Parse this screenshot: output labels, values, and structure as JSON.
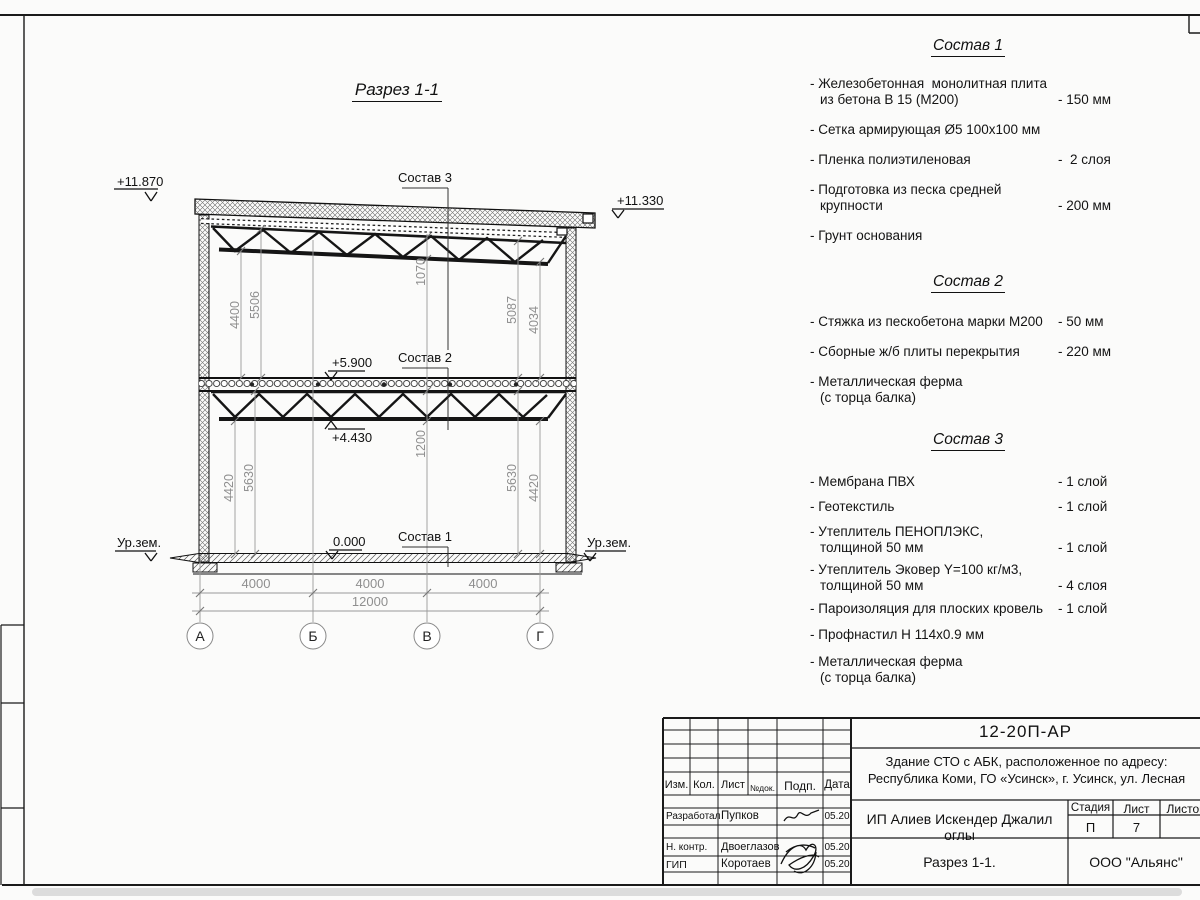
{
  "section": {
    "title": "Разрез 1-1",
    "callouts": {
      "c1": "Состав 1",
      "c2": "Состав 2",
      "c3": "Состав 3"
    },
    "elevations": {
      "roof_left": "+11.870",
      "roof_right": "+11.330",
      "floor": "+5.900",
      "truss": "+4.430",
      "zero": "0.000",
      "ground_left": "Ур.зем.",
      "ground_right": "Ур.зем."
    },
    "dims": {
      "tl1": "4400",
      "tl2": "5506",
      "mid_top": "1070",
      "tr1": "5087",
      "tr2": "4034",
      "bl1": "4420",
      "bl2": "5630",
      "mid_bot": "1200",
      "br1": "5630",
      "br2": "4420",
      "span1": "4000",
      "span2": "4000",
      "span3": "4000",
      "total": "12000"
    },
    "axes": {
      "a": "А",
      "b": "Б",
      "v": "В",
      "g": "Г"
    }
  },
  "compositions": [
    {
      "title": "Состав 1",
      "items": [
        {
          "l1": "- Железобетонная  монолитная плита",
          "l2": "из бетона В 15 (М200)",
          "v": "- 150 мм"
        },
        {
          "l1": "- Сетка армирующая Ø5 100х100 мм"
        },
        {
          "l1": "- Пленка полиэтиленовая",
          "v": "-  2 слоя"
        },
        {
          "l1": "- Подготовка из песка средней",
          "l2": "крупности",
          "v": "- 200 мм"
        },
        {
          "l1": "- Грунт основания"
        }
      ]
    },
    {
      "title": "Состав 2",
      "items": [
        {
          "l1": "- Стяжка из пескобетона марки М200",
          "v": "- 50 мм"
        },
        {
          "l1": "- Сборные ж/б плиты перекрытия",
          "v": "- 220 мм"
        },
        {
          "l1": "- Металлическая ферма",
          "l2": "(с торца балка)"
        }
      ]
    },
    {
      "title": "Состав 3",
      "items": [
        {
          "l1": "- Мембрана ПВХ",
          "v": "- 1 слой"
        },
        {
          "l1": "- Геотекстиль",
          "v": "- 1 слой"
        },
        {
          "l1": "- Утеплитель ПЕНОПЛЭКС,",
          "l2": "толщиной 50 мм",
          "v": "- 1 слой"
        },
        {
          "l1": "- Утеплитель Эковер Y=100 кг/м3,",
          "l2": "толщиной 50 мм",
          "v": "- 4 слоя"
        },
        {
          "l1": "- Пароизоляция для плоских кровель",
          "v": "- 1 слой"
        },
        {
          "l1": "- Профнастил Н 114х0.9 мм"
        },
        {
          "l1": "- Металлическая ферма",
          "l2": "(с торца балка)"
        }
      ]
    }
  ],
  "titleblock": {
    "doc_number": "12-20П-АР",
    "object_line1": "Здание СТО с АБК, расположенное по адресу:",
    "object_line2": "Республика Коми, ГО «Усинск», г. Усинск, ул. Лесная",
    "col_izm": "Изм.",
    "col_kol": "Кол.",
    "col_list": "Лист",
    "col_ndok": "№док.",
    "col_podp": "Подп.",
    "col_data": "Дата",
    "row1_role": "Разработал",
    "row1_name": "Пупков",
    "row1_date": "05.20",
    "row2_role": "Н. контр.",
    "row2_name": "Двоеглазов",
    "row2_date": "05.20",
    "row3_role": "ГИП",
    "row3_name": "Коротаев",
    "row3_date": "05.20",
    "client": "ИП Алиев Искендер Джалил оглы",
    "stage_label": "Стадия",
    "sheet_label": "Лист",
    "sheets_label": "Листов",
    "stage": "П",
    "sheet_no": "7",
    "drawing_name": "Разрез 1-1.",
    "company": "ООО \"Альянс\""
  }
}
